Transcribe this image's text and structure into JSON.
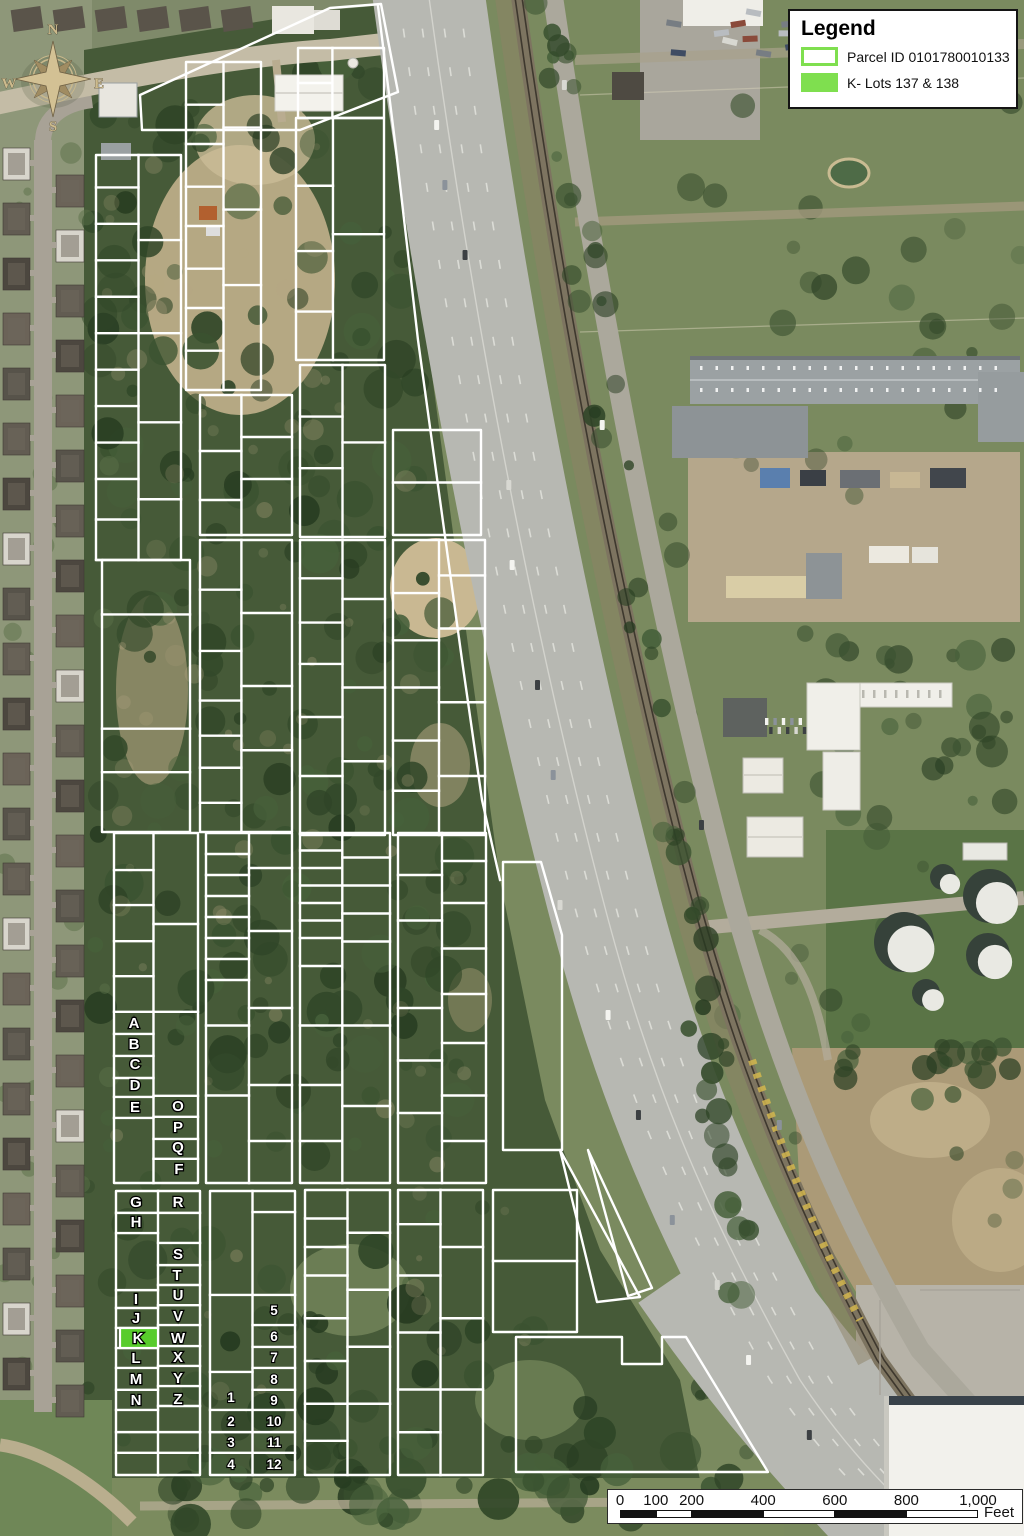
{
  "legend": {
    "title": "Legend",
    "items": [
      {
        "label": "Parcel ID 0101780010133",
        "swatch": "outline"
      },
      {
        "label": "K- Lots 137 & 138",
        "swatch": "fill"
      }
    ],
    "swatch_green": "#7fdf4f"
  },
  "scalebar": {
    "unit": "Feet",
    "ticks": [
      {
        "label": "0",
        "feet": 0
      },
      {
        "label": "100",
        "feet": 100
      },
      {
        "label": "200",
        "feet": 200
      },
      {
        "label": "400",
        "feet": 400
      },
      {
        "label": "600",
        "feet": 600
      },
      {
        "label": "800",
        "feet": 800
      },
      {
        "label": "1,000",
        "feet": 1000
      }
    ],
    "segments": [
      [
        0,
        100,
        "dark"
      ],
      [
        100,
        200,
        "light"
      ],
      [
        200,
        400,
        "dark"
      ],
      [
        400,
        600,
        "light"
      ],
      [
        600,
        800,
        "dark"
      ],
      [
        800,
        1000,
        "light"
      ]
    ]
  },
  "compass": {
    "n": "N",
    "e": "E",
    "s": "S",
    "w": "W"
  },
  "map": {
    "parcel_line_color": "#ffffff",
    "k_lot_fill": "#58cc2c",
    "k_lot": {
      "label": "K",
      "x": 120,
      "y": 1328,
      "w": 38,
      "h": 20
    },
    "lot_labels": [
      {
        "t": "A",
        "x": 134,
        "y": 1023
      },
      {
        "t": "B",
        "x": 134,
        "y": 1044
      },
      {
        "t": "C",
        "x": 135,
        "y": 1064
      },
      {
        "t": "D",
        "x": 135,
        "y": 1085
      },
      {
        "t": "E",
        "x": 135,
        "y": 1107
      },
      {
        "t": "O",
        "x": 178,
        "y": 1106
      },
      {
        "t": "P",
        "x": 178,
        "y": 1127
      },
      {
        "t": "Q",
        "x": 178,
        "y": 1147
      },
      {
        "t": "F",
        "x": 179,
        "y": 1169
      },
      {
        "t": "G",
        "x": 136,
        "y": 1202
      },
      {
        "t": "H",
        "x": 136,
        "y": 1222
      },
      {
        "t": "I",
        "x": 136,
        "y": 1299
      },
      {
        "t": "J",
        "x": 136,
        "y": 1318
      },
      {
        "t": "K",
        "x": 138,
        "y": 1338
      },
      {
        "t": "L",
        "x": 136,
        "y": 1358
      },
      {
        "t": "M",
        "x": 136,
        "y": 1379
      },
      {
        "t": "N",
        "x": 136,
        "y": 1400
      },
      {
        "t": "R",
        "x": 178,
        "y": 1202
      },
      {
        "t": "S",
        "x": 178,
        "y": 1254
      },
      {
        "t": "T",
        "x": 177,
        "y": 1275
      },
      {
        "t": "U",
        "x": 178,
        "y": 1295
      },
      {
        "t": "V",
        "x": 178,
        "y": 1316
      },
      {
        "t": "W",
        "x": 178,
        "y": 1338
      },
      {
        "t": "X",
        "x": 178,
        "y": 1357
      },
      {
        "t": "Y",
        "x": 178,
        "y": 1378
      },
      {
        "t": "Z",
        "x": 178,
        "y": 1399
      },
      {
        "t": "1",
        "x": 231,
        "y": 1397,
        "n": 1
      },
      {
        "t": "2",
        "x": 231,
        "y": 1421,
        "n": 1
      },
      {
        "t": "3",
        "x": 231,
        "y": 1442,
        "n": 1
      },
      {
        "t": "4",
        "x": 231,
        "y": 1464,
        "n": 1
      },
      {
        "t": "5",
        "x": 274,
        "y": 1310,
        "n": 1
      },
      {
        "t": "6",
        "x": 274,
        "y": 1336,
        "n": 1
      },
      {
        "t": "7",
        "x": 274,
        "y": 1357,
        "n": 1
      },
      {
        "t": "8",
        "x": 274,
        "y": 1379,
        "n": 1
      },
      {
        "t": "9",
        "x": 274,
        "y": 1400,
        "n": 1
      },
      {
        "t": "10",
        "x": 274,
        "y": 1421,
        "n": 1
      },
      {
        "t": "11",
        "x": 274,
        "y": 1442,
        "n": 1
      },
      {
        "t": "12",
        "x": 274,
        "y": 1464,
        "n": 1
      }
    ],
    "blocks": [
      {
        "x": 96,
        "y": 155,
        "w": 85,
        "h": 405,
        "v": 0.5,
        "l": [
          0.08,
          0.17,
          0.26,
          0.35,
          0.44,
          0.53,
          0.62,
          0.71,
          0.8,
          0.9
        ],
        "r": [
          0.21,
          0.44,
          0.66,
          0.85
        ]
      },
      {
        "x": 102,
        "y": 560,
        "w": 88,
        "h": 272,
        "v": null,
        "l": [
          0.2,
          0.62,
          0.78
        ],
        "r": []
      },
      {
        "x": 186,
        "y": 62,
        "w": 75,
        "h": 328,
        "v": 0.5,
        "l": [
          0.13,
          0.25,
          0.38,
          0.5,
          0.63,
          0.75,
          0.88
        ],
        "r": [
          0.2,
          0.45,
          0.68
        ]
      },
      {
        "x": 200,
        "y": 395,
        "w": 92,
        "h": 140,
        "v": 0.45,
        "l": [
          0.4,
          0.75
        ],
        "r": [
          0.3,
          0.6
        ]
      },
      {
        "x": 200,
        "y": 540,
        "w": 92,
        "h": 292,
        "v": 0.45,
        "l": [
          0.17,
          0.38,
          0.55,
          0.67,
          0.78,
          0.9
        ],
        "r": [
          0.25,
          0.5,
          0.72
        ]
      },
      {
        "x": 298,
        "y": 48,
        "w": 86,
        "h": 70,
        "v": 0.4,
        "l": [
          0.5
        ],
        "r": []
      },
      {
        "x": 296,
        "y": 118,
        "w": 88,
        "h": 242,
        "v": 0.42,
        "l": [
          0.28,
          0.55,
          0.8
        ],
        "r": [
          0.48
        ]
      },
      {
        "x": 300,
        "y": 365,
        "w": 85,
        "h": 172,
        "v": 0.5,
        "l": [
          0.3,
          0.6
        ],
        "r": [
          0.45
        ]
      },
      {
        "x": 300,
        "y": 540,
        "w": 85,
        "h": 295,
        "v": 0.5,
        "l": [
          0.13,
          0.28,
          0.42,
          0.6,
          0.8
        ],
        "r": [
          0.2,
          0.5,
          0.75
        ]
      },
      {
        "x": 393,
        "y": 430,
        "w": 88,
        "h": 105,
        "v": null,
        "l": [
          0.5
        ],
        "r": []
      },
      {
        "x": 393,
        "y": 540,
        "w": 92,
        "h": 295,
        "v": 0.5,
        "l": [
          0.18,
          0.34,
          0.5,
          0.68,
          0.85
        ],
        "r": [
          0.12,
          0.3,
          0.55,
          0.8
        ]
      },
      {
        "x": 114,
        "y": 833,
        "w": 84,
        "h": 350,
        "v": 0.47,
        "l": [
          0.106,
          0.206,
          0.309,
          0.409,
          0.511,
          0.574,
          0.637,
          0.7,
          0.754,
          0.814
        ],
        "r": [
          0.26,
          0.511,
          0.751,
          0.811,
          0.874,
          0.931
        ]
      },
      {
        "x": 206,
        "y": 833,
        "w": 86,
        "h": 350,
        "v": 0.5,
        "l": [
          0.06,
          0.12,
          0.18,
          0.24,
          0.3,
          0.36,
          0.42,
          0.55,
          0.75
        ],
        "r": [
          0.1,
          0.28,
          0.5,
          0.72,
          0.88
        ]
      },
      {
        "x": 300,
        "y": 833,
        "w": 90,
        "h": 350,
        "v": 0.47,
        "l": [
          0.05,
          0.1,
          0.15,
          0.2,
          0.25,
          0.3,
          0.38,
          0.55,
          0.72,
          0.88
        ],
        "r": [
          0.07,
          0.15,
          0.23,
          0.31,
          0.55,
          0.78
        ]
      },
      {
        "x": 398,
        "y": 833,
        "w": 88,
        "h": 350,
        "v": 0.5,
        "l": [
          0.12,
          0.25,
          0.5,
          0.65,
          0.8
        ],
        "r": [
          0.08,
          0.2,
          0.33,
          0.46,
          0.6,
          0.75,
          0.88
        ]
      },
      {
        "x": 116,
        "y": 1191,
        "w": 84,
        "h": 284,
        "v": 0.5,
        "l": [
          0.077,
          0.148,
          0.349,
          0.412,
          0.482,
          0.553,
          0.623,
          0.7,
          0.771,
          0.849,
          0.922
        ],
        "r": [
          0.077,
          0.183,
          0.261,
          0.331,
          0.402,
          0.472,
          0.546,
          0.616,
          0.687,
          0.757,
          0.849,
          0.922
        ]
      },
      {
        "x": 210,
        "y": 1191,
        "w": 85,
        "h": 284,
        "v": 0.5,
        "l": [
          0.366,
          0.637,
          0.771,
          0.849,
          0.922
        ],
        "r": [
          0.074,
          0.366,
          0.472,
          0.549,
          0.623,
          0.7,
          0.771,
          0.849,
          0.922
        ]
      },
      {
        "x": 305,
        "y": 1190,
        "w": 85,
        "h": 285,
        "v": 0.5,
        "l": [
          0.1,
          0.2,
          0.3,
          0.45,
          0.6,
          0.75,
          0.88
        ],
        "r": [
          0.15,
          0.35,
          0.55,
          0.75
        ]
      },
      {
        "x": 398,
        "y": 1190,
        "w": 85,
        "h": 285,
        "v": 0.5,
        "l": [
          0.12,
          0.3,
          0.5,
          0.7,
          0.85
        ],
        "r": [
          0.2,
          0.45,
          0.7
        ]
      },
      {
        "x": 493,
        "y": 1190,
        "w": 84,
        "h": 142,
        "v": null,
        "l": [
          0.5
        ],
        "r": []
      }
    ],
    "polygons": [
      {
        "pts": [
          [
            140,
            95
          ],
          [
            330,
            8
          ],
          [
            381,
            4
          ],
          [
            398,
            92
          ],
          [
            300,
            130
          ],
          [
            142,
            130
          ]
        ]
      },
      {
        "pts": [
          [
            503,
            862
          ],
          [
            541,
            862
          ],
          [
            562,
            935
          ],
          [
            562,
            1150
          ],
          [
            503,
            1150
          ]
        ]
      },
      {
        "pts": [
          [
            516,
            1337
          ],
          [
            622,
            1337
          ],
          [
            622,
            1364
          ],
          [
            662,
            1364
          ],
          [
            662,
            1337
          ],
          [
            686,
            1337
          ],
          [
            768,
            1472
          ],
          [
            516,
            1472
          ]
        ]
      },
      {
        "pts": [
          [
            560,
            1150
          ],
          [
            640,
            1297
          ],
          [
            597,
            1302
          ]
        ]
      },
      {
        "pts": [
          [
            588,
            1150
          ],
          [
            652,
            1288
          ],
          [
            628,
            1296
          ]
        ]
      }
    ],
    "polylines": [
      {
        "pts": [
          [
            378,
            6
          ],
          [
            396,
            150
          ],
          [
            418,
            340
          ],
          [
            440,
            500
          ],
          [
            462,
            660
          ],
          [
            482,
            800
          ],
          [
            500,
            880
          ]
        ]
      },
      {
        "pts": [
          [
            102,
            560
          ],
          [
            96,
            560
          ]
        ]
      }
    ]
  }
}
